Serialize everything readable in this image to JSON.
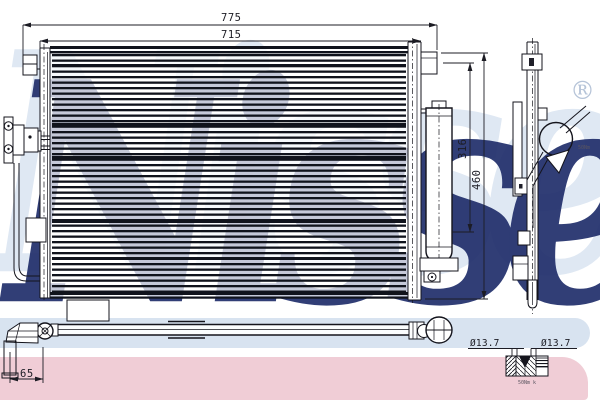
{
  "watermark": {
    "brand": "Nissens",
    "registered": "®",
    "navy_color": "#22306c",
    "light_color": "#dfe8f3",
    "band_blue_color": "#d8e3f0",
    "band_pink_color": "#f0cdd6"
  },
  "dimensions": {
    "overall_width": "775",
    "core_width": "715",
    "upper_height": "316",
    "total_height": "460",
    "pipe_offset": "65",
    "port_dia_left": "Ø13.7",
    "port_dia_right": "Ø13.7"
  },
  "notes": {
    "side_fitting_note": "50Nm",
    "detail_fitting_note": "50Nm k"
  }
}
